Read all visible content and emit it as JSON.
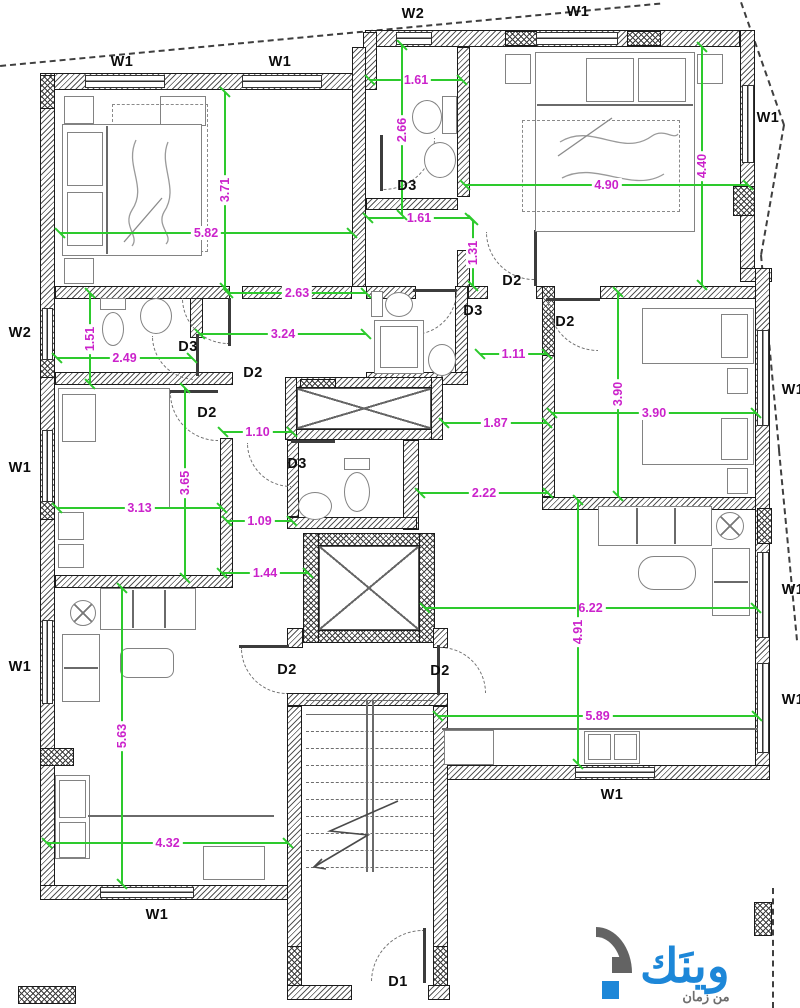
{
  "page": {
    "type": "apartment floor plan drawing",
    "width_px": 800,
    "height_px": 1008
  },
  "colors": {
    "dimension_line": "#2dca2d",
    "dimension_text": "#cb22cb",
    "label_text": "#0d0d0d",
    "wall_outline": "#1b1b1b",
    "logo_blue": "#1d87d8",
    "logo_gray": "#6e6e6e"
  },
  "labels": {
    "window_labels": [
      {
        "t": "W1",
        "x": 122,
        "y": 62
      },
      {
        "t": "W1",
        "x": 280,
        "y": 62
      },
      {
        "t": "W2",
        "x": 413,
        "y": 14
      },
      {
        "t": "W1",
        "x": 578,
        "y": 12
      },
      {
        "t": "W1",
        "x": 768,
        "y": 118
      },
      {
        "t": "W2",
        "x": 20,
        "y": 333
      },
      {
        "t": "W1",
        "x": 20,
        "y": 468
      },
      {
        "t": "W1",
        "x": 20,
        "y": 667
      },
      {
        "t": "W1",
        "x": 793,
        "y": 390
      },
      {
        "t": "W1",
        "x": 793,
        "y": 590
      },
      {
        "t": "W1",
        "x": 793,
        "y": 700
      },
      {
        "t": "W1",
        "x": 157,
        "y": 915
      },
      {
        "t": "W1",
        "x": 612,
        "y": 795
      }
    ],
    "door_labels": [
      {
        "t": "D1",
        "x": 398,
        "y": 982
      },
      {
        "t": "D2",
        "x": 512,
        "y": 281
      },
      {
        "t": "D2",
        "x": 565,
        "y": 322
      },
      {
        "t": "D2",
        "x": 253,
        "y": 373
      },
      {
        "t": "D2",
        "x": 207,
        "y": 413
      },
      {
        "t": "D2",
        "x": 287,
        "y": 670
      },
      {
        "t": "D2",
        "x": 440,
        "y": 671
      },
      {
        "t": "D3",
        "x": 407,
        "y": 186
      },
      {
        "t": "D3",
        "x": 188,
        "y": 347
      },
      {
        "t": "D3",
        "x": 473,
        "y": 311
      },
      {
        "t": "D3",
        "x": 297,
        "y": 464
      }
    ]
  },
  "dimensions": {
    "unit": "m",
    "horizontal": [
      {
        "v": "1.61",
        "y": 80,
        "x1": 370,
        "x2": 462
      },
      {
        "v": "4.90",
        "y": 185,
        "x1": 465,
        "x2": 748
      },
      {
        "v": "5.82",
        "y": 233,
        "x1": 60,
        "x2": 352
      },
      {
        "v": "1.61",
        "y": 218,
        "x1": 368,
        "x2": 470
      },
      {
        "v": "2.63",
        "y": 293,
        "x1": 228,
        "x2": 366
      },
      {
        "v": "3.24",
        "y": 334,
        "x1": 200,
        "x2": 366
      },
      {
        "v": "2.49",
        "y": 358,
        "x1": 57,
        "x2": 192
      },
      {
        "v": "1.11",
        "y": 354,
        "x1": 480,
        "x2": 547
      },
      {
        "v": "3.90",
        "y": 413,
        "x1": 552,
        "x2": 756
      },
      {
        "v": "1.10",
        "y": 432,
        "x1": 223,
        "x2": 292
      },
      {
        "v": "1.87",
        "y": 423,
        "x1": 444,
        "x2": 547
      },
      {
        "v": "3.13",
        "y": 508,
        "x1": 57,
        "x2": 222
      },
      {
        "v": "2.22",
        "y": 493,
        "x1": 420,
        "x2": 548
      },
      {
        "v": "1.09",
        "y": 521,
        "x1": 227,
        "x2": 292
      },
      {
        "v": "1.44",
        "y": 573,
        "x1": 222,
        "x2": 308
      },
      {
        "v": "6.22",
        "y": 608,
        "x1": 425,
        "x2": 756
      },
      {
        "v": "5.89",
        "y": 716,
        "x1": 438,
        "x2": 757
      },
      {
        "v": "4.32",
        "y": 843,
        "x1": 47,
        "x2": 288
      }
    ],
    "vertical": [
      {
        "v": "2.66",
        "x": 402,
        "y1": 45,
        "y2": 215
      },
      {
        "v": "4.40",
        "x": 702,
        "y1": 47,
        "y2": 285
      },
      {
        "v": "3.71",
        "x": 225,
        "y1": 92,
        "y2": 288
      },
      {
        "v": "1.31",
        "x": 473,
        "y1": 220,
        "y2": 286
      },
      {
        "v": "1.51",
        "x": 90,
        "y1": 293,
        "y2": 384
      },
      {
        "v": "3.90",
        "x": 618,
        "y1": 292,
        "y2": 496
      },
      {
        "v": "3.65",
        "x": 185,
        "y1": 388,
        "y2": 578
      },
      {
        "v": "4.91",
        "x": 578,
        "y1": 500,
        "y2": 764
      },
      {
        "v": "5.63",
        "x": 122,
        "y1": 588,
        "y2": 884
      }
    ]
  },
  "logo": {
    "name": "وينَك",
    "tagline": "من زمان"
  }
}
